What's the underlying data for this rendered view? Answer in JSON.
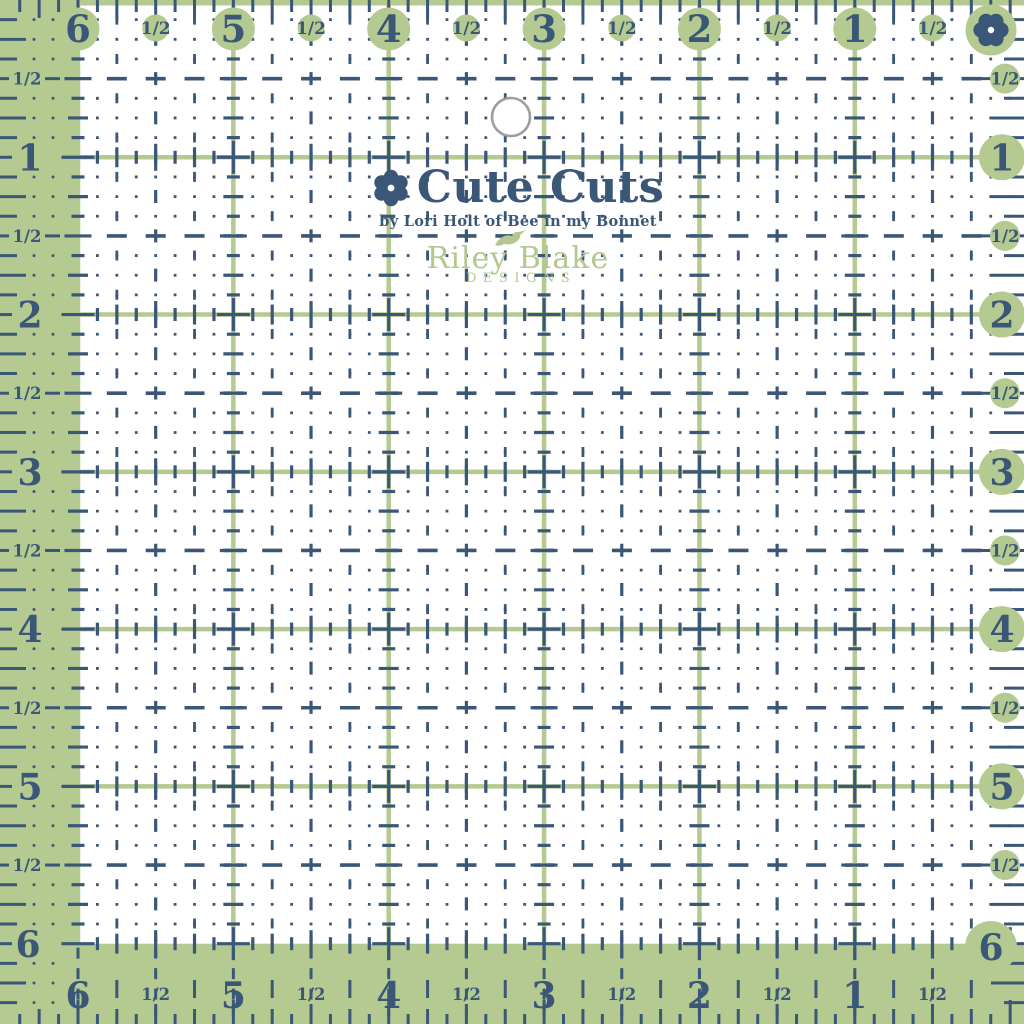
{
  "product": {
    "kind": "quilting ruler",
    "shape": "square with grid of dashed measurement lines and a hanging hole"
  },
  "brand": {
    "logo_title": "Cute Cuts",
    "logo_subtitle": "by Lori Holt of Bee in my Bonnet",
    "maker_line1": "Riley Blake",
    "maker_line2": "DESIGNS"
  },
  "scales": {
    "top": [
      "6",
      "1/2",
      "5",
      "1/2",
      "4",
      "1/2",
      "3",
      "1/2",
      "2",
      "1/2",
      "1",
      "1/2"
    ],
    "left": [
      "1/2",
      "1",
      "1/2",
      "2",
      "1/2",
      "3",
      "1/2",
      "4",
      "1/2",
      "5",
      "1/2",
      "6"
    ],
    "right": [
      "1/2",
      "1",
      "1/2",
      "2",
      "1/2",
      "3",
      "1/2",
      "4",
      "1/2",
      "5",
      "1/2",
      "6"
    ],
    "bottom": [
      "6",
      "1/2",
      "5",
      "1/2",
      "4",
      "1/2",
      "3",
      "1/2",
      "2",
      "1/2",
      "1",
      "1/2"
    ]
  },
  "icons": {
    "top_right_corner": "flower-icon",
    "logo_mark": "flower-icon",
    "maker_mark": "bird-icon",
    "hole": "hanging-hole"
  },
  "colors": {
    "green": "#b5ca90",
    "navy": "#3b5777",
    "logo_green": "#b3c78e",
    "hole_ring": "#9e9e9e",
    "background": "#ffffff"
  }
}
